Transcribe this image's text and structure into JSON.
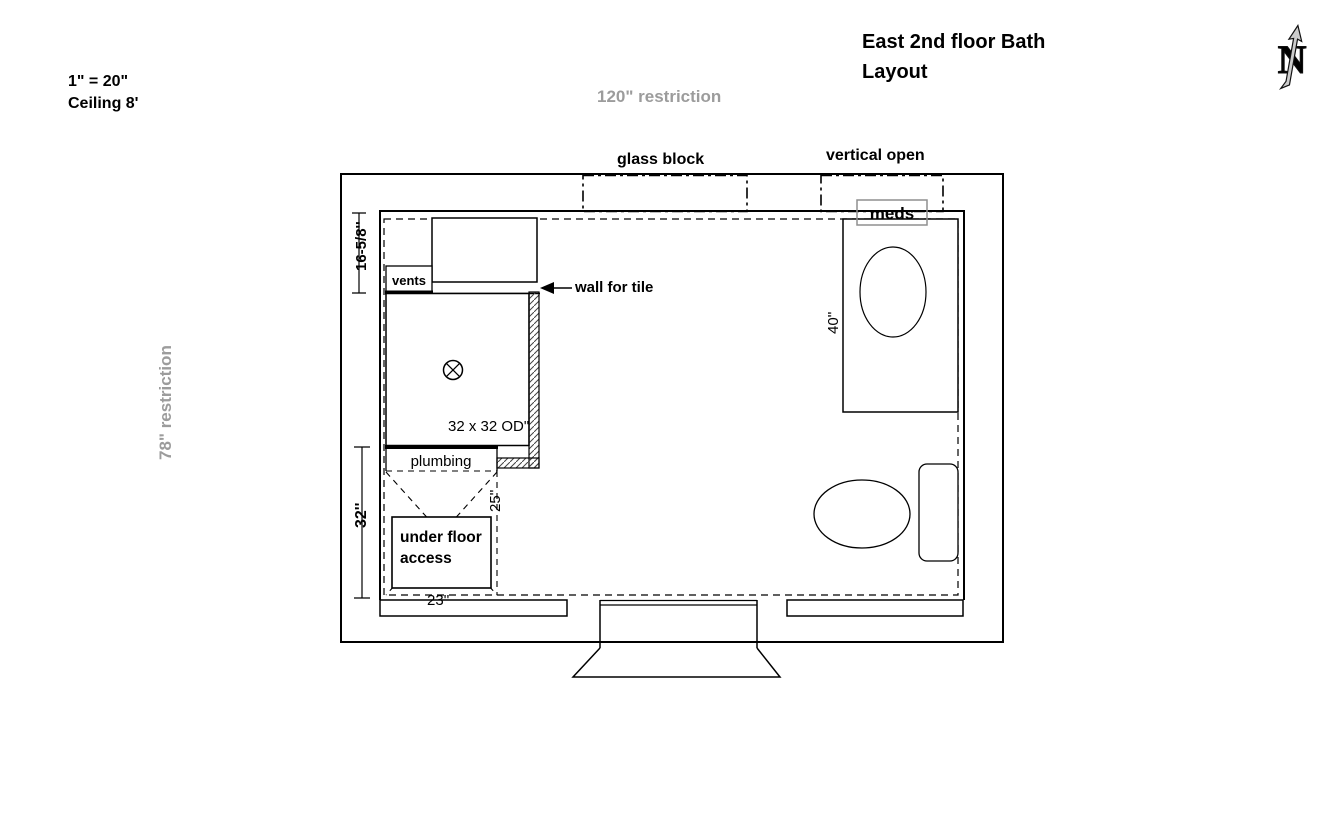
{
  "title": {
    "line1": "East 2nd floor Bath",
    "line2": "Layout"
  },
  "scale_notes": {
    "scale": "1\" = 20\"",
    "ceiling": "Ceiling 8'"
  },
  "restrictions": {
    "top": "120\" restriction",
    "left": "78\" restriction"
  },
  "wall_openings": {
    "glass_block": "glass block",
    "vertical_open": "vertical open"
  },
  "labels": {
    "meds": "meds",
    "vents": "vents",
    "wall_for_tile": "wall for tile",
    "shower_size": "32 x 32 OD\"",
    "plumbing": "plumbing",
    "under_floor_line1": "under floor",
    "under_floor_line2": "access"
  },
  "dimensions": {
    "wall_top_left": "16-5/8''",
    "wall_bottom_left": "32''",
    "plumbing_depth": "25''",
    "access_width": "23''",
    "vanity_length": "40''"
  },
  "compass": {
    "letter": "N"
  },
  "colors": {
    "line": "#000000",
    "restriction_gray": "#9c9c9c",
    "meds_box_border": "#8f8f8f",
    "compass_fill": "#cccccc",
    "background": "#ffffff"
  }
}
